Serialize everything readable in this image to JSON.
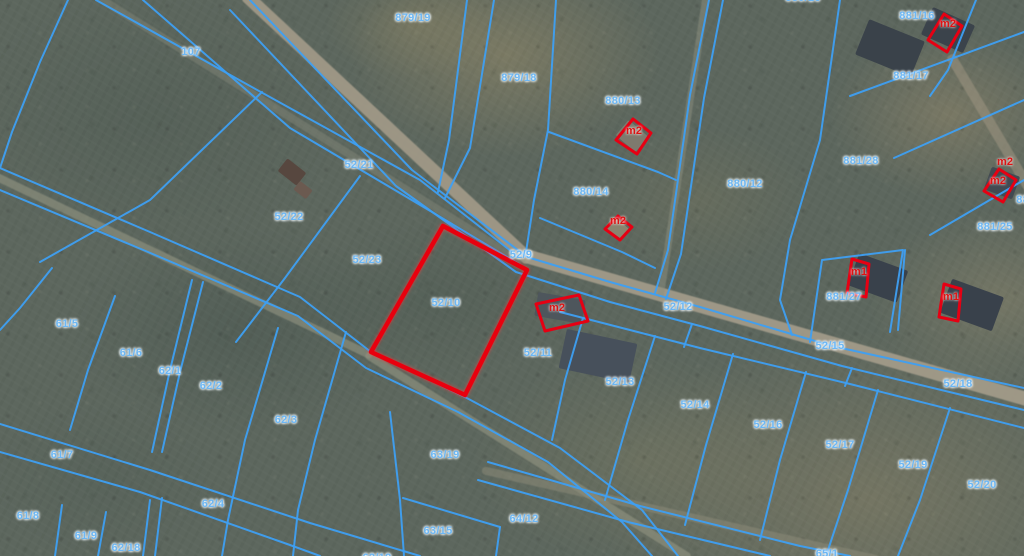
{
  "map": {
    "description": "Cadastral parcel map over aerial imagery",
    "colors": {
      "parcel_line": "#3e9ff2",
      "parcel_label": "#6db7f4",
      "selected_outline": "#e8000e",
      "building_outline": "#e60013",
      "building_label": "#dd1414"
    },
    "selected_parcel": {
      "id": "52/10",
      "polygon": [
        [
          443,
          226
        ],
        [
          527,
          270
        ],
        [
          465,
          395
        ],
        [
          371,
          352
        ]
      ]
    },
    "parcel_labels": [
      {
        "text": "879/19",
        "x": 413,
        "y": 18
      },
      {
        "text": "879/18",
        "x": 519,
        "y": 78
      },
      {
        "text": "107",
        "x": 191,
        "y": 52
      },
      {
        "text": "880/16",
        "x": 803,
        "y": -2,
        "clipped": true
      },
      {
        "text": "52/21",
        "x": 359,
        "y": 165
      },
      {
        "text": "52/22",
        "x": 289,
        "y": 217
      },
      {
        "text": "52/23",
        "x": 367,
        "y": 260
      },
      {
        "text": "880/13",
        "x": 623,
        "y": 101
      },
      {
        "text": "880/14",
        "x": 591,
        "y": 192
      },
      {
        "text": "880/12",
        "x": 745,
        "y": 184
      },
      {
        "text": "881/16",
        "x": 917,
        "y": 16
      },
      {
        "text": "881/17",
        "x": 911,
        "y": 76
      },
      {
        "text": "881/28",
        "x": 861,
        "y": 161
      },
      {
        "text": "881/25",
        "x": 995,
        "y": 227
      },
      {
        "text": "881/26",
        "x": 1034,
        "y": 200,
        "clipped": true
      },
      {
        "text": "881/27",
        "x": 844,
        "y": 297
      },
      {
        "text": "52/9",
        "x": 521,
        "y": 255
      },
      {
        "text": "52/10",
        "x": 446,
        "y": 303
      },
      {
        "text": "52/11",
        "x": 538,
        "y": 353
      },
      {
        "text": "52/12",
        "x": 678,
        "y": 307
      },
      {
        "text": "52/13",
        "x": 620,
        "y": 382
      },
      {
        "text": "52/14",
        "x": 695,
        "y": 405
      },
      {
        "text": "52/15",
        "x": 830,
        "y": 346
      },
      {
        "text": "52/16",
        "x": 768,
        "y": 425
      },
      {
        "text": "52/17",
        "x": 840,
        "y": 445
      },
      {
        "text": "52/18",
        "x": 958,
        "y": 384
      },
      {
        "text": "52/19",
        "x": 913,
        "y": 465
      },
      {
        "text": "52/20",
        "x": 982,
        "y": 485
      },
      {
        "text": "61/5",
        "x": 67,
        "y": 324
      },
      {
        "text": "61/6",
        "x": 131,
        "y": 353
      },
      {
        "text": "62/1",
        "x": 170,
        "y": 371
      },
      {
        "text": "62/2",
        "x": 211,
        "y": 386
      },
      {
        "text": "62/3",
        "x": 286,
        "y": 420
      },
      {
        "text": "61/7",
        "x": 62,
        "y": 455
      },
      {
        "text": "61/8",
        "x": 28,
        "y": 516
      },
      {
        "text": "61/9",
        "x": 86,
        "y": 536
      },
      {
        "text": "62/18",
        "x": 126,
        "y": 548
      },
      {
        "text": "62/4",
        "x": 213,
        "y": 504
      },
      {
        "text": "63/19",
        "x": 445,
        "y": 455
      },
      {
        "text": "63/15",
        "x": 438,
        "y": 531
      },
      {
        "text": "64/12",
        "x": 524,
        "y": 519
      },
      {
        "text": "62/19",
        "x": 377,
        "y": 558,
        "clipped": true
      },
      {
        "text": "65/1",
        "x": 827,
        "y": 554,
        "clipped": true
      }
    ],
    "building_labels": [
      {
        "text": "m2",
        "x": 634,
        "y": 131
      },
      {
        "text": "m2",
        "x": 618,
        "y": 221
      },
      {
        "text": "m2",
        "x": 948,
        "y": 24
      },
      {
        "text": "m2",
        "x": 1005,
        "y": 162
      },
      {
        "text": "m2",
        "x": 998,
        "y": 181
      },
      {
        "text": "m1",
        "x": 859,
        "y": 272
      },
      {
        "text": "m1",
        "x": 951,
        "y": 297
      },
      {
        "text": "m2",
        "x": 557,
        "y": 308
      }
    ],
    "outlined_buildings": [
      {
        "label": "m2",
        "points": [
          [
            633,
            119
          ],
          [
            651,
            133
          ],
          [
            637,
            154
          ],
          [
            616,
            140
          ]
        ]
      },
      {
        "label": "m2",
        "points": [
          [
            618,
            216
          ],
          [
            632,
            227
          ],
          [
            620,
            240
          ],
          [
            605,
            229
          ]
        ]
      },
      {
        "label": "m2",
        "points": [
          [
            944,
            14
          ],
          [
            962,
            26
          ],
          [
            947,
            52
          ],
          [
            928,
            40
          ]
        ]
      },
      {
        "label": "m2",
        "points": [
          [
            999,
            169
          ],
          [
            1016,
            180
          ],
          [
            1003,
            202
          ],
          [
            984,
            191
          ]
        ]
      },
      {
        "label": "m1",
        "points": [
          [
            852,
            259
          ],
          [
            869,
            264
          ],
          [
            866,
            297
          ],
          [
            847,
            293
          ]
        ]
      },
      {
        "label": "m1",
        "points": [
          [
            944,
            284
          ],
          [
            961,
            289
          ],
          [
            958,
            321
          ],
          [
            939,
            317
          ]
        ]
      },
      {
        "label": "m2",
        "points": [
          [
            536,
            304
          ],
          [
            579,
            295
          ],
          [
            588,
            321
          ],
          [
            545,
            331
          ]
        ]
      }
    ],
    "boundary_lines": [
      [
        [
          250,
          0
        ],
        [
          412,
          170
        ],
        [
          527,
          257
        ],
        [
          610,
          282
        ],
        [
          700,
          307
        ],
        [
          832,
          346
        ],
        [
          1024,
          388
        ]
      ],
      [
        [
          230,
          10
        ],
        [
          396,
          186
        ],
        [
          516,
          272
        ],
        [
          610,
          302
        ],
        [
          700,
          326
        ],
        [
          842,
          366
        ],
        [
          1024,
          410
        ]
      ],
      [
        [
          0,
          168
        ],
        [
          150,
          232
        ],
        [
          300,
          297
        ],
        [
          371,
          352
        ],
        [
          463,
          396
        ],
        [
          560,
          448
        ],
        [
          642,
          510
        ],
        [
          678,
          556
        ]
      ],
      [
        [
          0,
          190
        ],
        [
          148,
          252
        ],
        [
          298,
          316
        ],
        [
          366,
          368
        ],
        [
          458,
          412
        ],
        [
          548,
          462
        ],
        [
          622,
          522
        ],
        [
          652,
          556
        ]
      ],
      [
        [
          68,
          0
        ],
        [
          40,
          62
        ],
        [
          12,
          132
        ],
        [
          0,
          168
        ]
      ],
      [
        [
          96,
          0
        ],
        [
          250,
          86
        ],
        [
          420,
          180
        ],
        [
          516,
          255
        ]
      ],
      [
        [
          143,
          0
        ],
        [
          290,
          128
        ],
        [
          432,
          212
        ],
        [
          522,
          266
        ]
      ],
      [
        [
          467,
          0
        ],
        [
          449,
          140
        ],
        [
          438,
          192
        ]
      ],
      [
        [
          494,
          0
        ],
        [
          470,
          148
        ],
        [
          445,
          198
        ]
      ],
      [
        [
          556,
          0
        ],
        [
          548,
          130
        ],
        [
          534,
          200
        ],
        [
          526,
          252
        ]
      ],
      [
        [
          549,
          132
        ],
        [
          658,
          172
        ],
        [
          676,
          180
        ]
      ],
      [
        [
          540,
          218
        ],
        [
          622,
          252
        ],
        [
          655,
          268
        ]
      ],
      [
        [
          709,
          0
        ],
        [
          690,
          95
        ],
        [
          668,
          250
        ],
        [
          655,
          293
        ]
      ],
      [
        [
          723,
          0
        ],
        [
          704,
          98
        ],
        [
          681,
          254
        ],
        [
          666,
          299
        ]
      ],
      [
        [
          840,
          0
        ],
        [
          820,
          140
        ],
        [
          790,
          240
        ],
        [
          780,
          300
        ],
        [
          792,
          335
        ]
      ],
      [
        [
          976,
          0
        ],
        [
          948,
          70
        ],
        [
          930,
          96
        ]
      ],
      [
        [
          850,
          96
        ],
        [
          1024,
          32
        ]
      ],
      [
        [
          894,
          158
        ],
        [
          1024,
          100
        ]
      ],
      [
        [
          930,
          235
        ],
        [
          1024,
          180
        ]
      ],
      [
        [
          810,
          342
        ],
        [
          822,
          260
        ],
        [
          903,
          250
        ],
        [
          890,
          332
        ]
      ],
      [
        [
          905,
          250
        ],
        [
          898,
          330
        ]
      ],
      [
        [
          560,
          312
        ],
        [
          700,
          348
        ],
        [
          850,
          384
        ],
        [
          1024,
          428
        ]
      ],
      [
        [
          692,
          324
        ],
        [
          684,
          347
        ]
      ],
      [
        [
          852,
          368
        ],
        [
          845,
          386
        ]
      ],
      [
        [
          583,
          318
        ],
        [
          565,
          380
        ],
        [
          552,
          440
        ]
      ],
      [
        [
          655,
          336
        ],
        [
          628,
          420
        ],
        [
          605,
          500
        ]
      ],
      [
        [
          733,
          354
        ],
        [
          706,
          445
        ],
        [
          685,
          525
        ]
      ],
      [
        [
          806,
          372
        ],
        [
          780,
          460
        ],
        [
          760,
          540
        ]
      ],
      [
        [
          878,
          390
        ],
        [
          848,
          490
        ],
        [
          826,
          556
        ]
      ],
      [
        [
          950,
          408
        ],
        [
          920,
          500
        ],
        [
          898,
          556
        ]
      ],
      [
        [
          488,
          462
        ],
        [
          640,
          506
        ],
        [
          800,
          546
        ],
        [
          850,
          556
        ]
      ],
      [
        [
          478,
          480
        ],
        [
          628,
          522
        ],
        [
          770,
          556
        ]
      ],
      [
        [
          52,
          268
        ],
        [
          20,
          308
        ],
        [
          0,
          330
        ]
      ],
      [
        [
          115,
          296
        ],
        [
          88,
          370
        ],
        [
          70,
          430
        ]
      ],
      [
        [
          192,
          280
        ],
        [
          170,
          370
        ],
        [
          152,
          452
        ]
      ],
      [
        [
          203,
          282
        ],
        [
          180,
          372
        ],
        [
          162,
          452
        ]
      ],
      [
        [
          278,
          328
        ],
        [
          245,
          440
        ],
        [
          228,
          520
        ],
        [
          222,
          556
        ]
      ],
      [
        [
          346,
          332
        ],
        [
          315,
          440
        ],
        [
          298,
          510
        ],
        [
          293,
          556
        ]
      ],
      [
        [
          0,
          424
        ],
        [
          150,
          470
        ],
        [
          310,
          523
        ],
        [
          420,
          556
        ]
      ],
      [
        [
          0,
          452
        ],
        [
          140,
          492
        ],
        [
          290,
          545
        ],
        [
          320,
          556
        ]
      ],
      [
        [
          62,
          505
        ],
        [
          55,
          556
        ]
      ],
      [
        [
          106,
          512
        ],
        [
          98,
          556
        ]
      ],
      [
        [
          150,
          500
        ],
        [
          143,
          556
        ]
      ],
      [
        [
          162,
          498
        ],
        [
          155,
          556
        ]
      ],
      [
        [
          390,
          412
        ],
        [
          400,
          500
        ],
        [
          404,
          556
        ]
      ],
      [
        [
          403,
          498
        ],
        [
          500,
          527
        ]
      ],
      [
        [
          500,
          527
        ],
        [
          496,
          556
        ]
      ],
      [
        [
          262,
          92
        ],
        [
          150,
          200
        ],
        [
          40,
          262
        ]
      ],
      [
        [
          360,
          176
        ],
        [
          285,
          278
        ],
        [
          236,
          342
        ]
      ]
    ],
    "roads": [
      {
        "x1": 245,
        "y1": -6,
        "x2": 530,
        "y2": 260,
        "w": 13,
        "color": "#a39b89",
        "op": 0.9
      },
      {
        "x1": 526,
        "y1": 256,
        "x2": 1030,
        "y2": 400,
        "w": 14,
        "color": "#a59d8b",
        "op": 0.9
      },
      {
        "x1": -5,
        "y1": 176,
        "x2": 372,
        "y2": 356,
        "w": 8,
        "color": "#8f9280",
        "op": 0.65
      },
      {
        "x1": 366,
        "y1": 354,
        "x2": 690,
        "y2": 558,
        "w": 8,
        "color": "#8f9280",
        "op": 0.65
      },
      {
        "x1": 482,
        "y1": 470,
        "x2": 880,
        "y2": 560,
        "w": 8,
        "color": "#8b8a78",
        "op": 0.55
      },
      {
        "x1": 96,
        "y1": -4,
        "x2": 522,
        "y2": 262,
        "w": 8,
        "color": "#84887a",
        "op": 0.45
      },
      {
        "x1": 706,
        "y1": -4,
        "x2": 660,
        "y2": 298,
        "w": 7,
        "color": "#8d9080",
        "op": 0.5
      },
      {
        "x1": 950,
        "y1": 55,
        "x2": 1030,
        "y2": 190,
        "w": 10,
        "color": "#9a927f",
        "op": 0.6
      }
    ],
    "roofs": [
      {
        "x": 890,
        "y": 48,
        "w": 60,
        "h": 38,
        "rot": 22,
        "color": "#3a424a"
      },
      {
        "x": 878,
        "y": 278,
        "w": 52,
        "h": 34,
        "rot": 20,
        "color": "#39414b"
      },
      {
        "x": 972,
        "y": 305,
        "w": 55,
        "h": 36,
        "rot": 20,
        "color": "#39414b"
      },
      {
        "x": 560,
        "y": 308,
        "w": 48,
        "h": 24,
        "rot": 10,
        "color": "#4e565c"
      },
      {
        "x": 598,
        "y": 356,
        "w": 72,
        "h": 40,
        "rot": 12,
        "color": "#47505b"
      },
      {
        "x": 948,
        "y": 30,
        "w": 46,
        "h": 30,
        "rot": 24,
        "color": "#3b434b"
      },
      {
        "x": 1002,
        "y": 183,
        "w": 30,
        "h": 24,
        "rot": 20,
        "color": "#424a52"
      },
      {
        "x": 292,
        "y": 172,
        "w": 24,
        "h": 16,
        "rot": 38,
        "color": "#57473f"
      },
      {
        "x": 303,
        "y": 190,
        "w": 16,
        "h": 11,
        "rot": 38,
        "color": "#6b5a50"
      },
      {
        "x": 632,
        "y": 136,
        "w": 26,
        "h": 20,
        "rot": 40,
        "color": "#7e7a6e"
      },
      {
        "x": 617,
        "y": 228,
        "w": 20,
        "h": 14,
        "rot": 40,
        "color": "#8a846f"
      }
    ]
  }
}
